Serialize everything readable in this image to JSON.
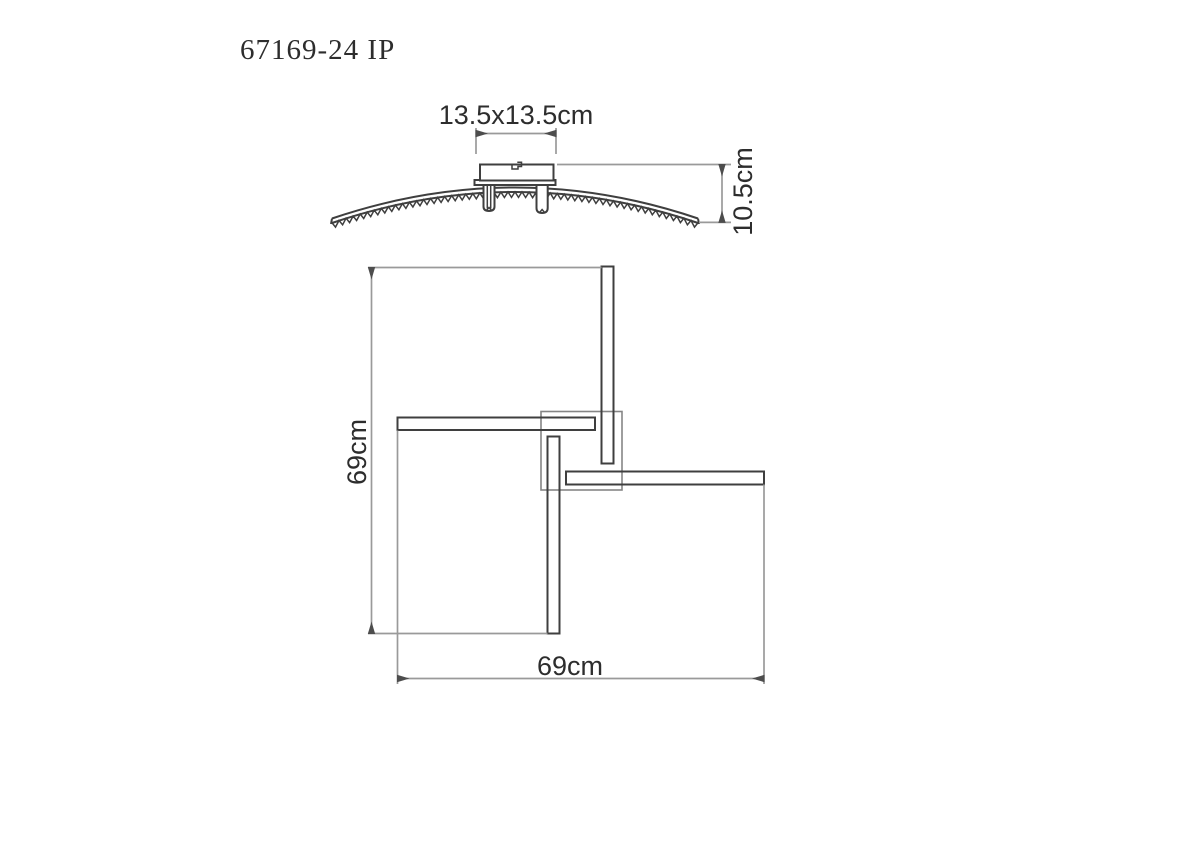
{
  "title": "67169-24 IP",
  "colors": {
    "background": "#ffffff",
    "drawing_line": "#3f3f3f",
    "dimension_line": "#9a9a9a",
    "arrow": "#4d4d4d",
    "text": "#2d2d2d",
    "hatch_line": "#4a4a4a",
    "bracket_outline": "#858585"
  },
  "side_view": {
    "labels": {
      "canopy_size": "13.5x13.5cm",
      "fixture_height": "10.5cm"
    }
  },
  "top_view": {
    "labels": {
      "overall_height": "69cm",
      "overall_width": "69cm"
    }
  }
}
